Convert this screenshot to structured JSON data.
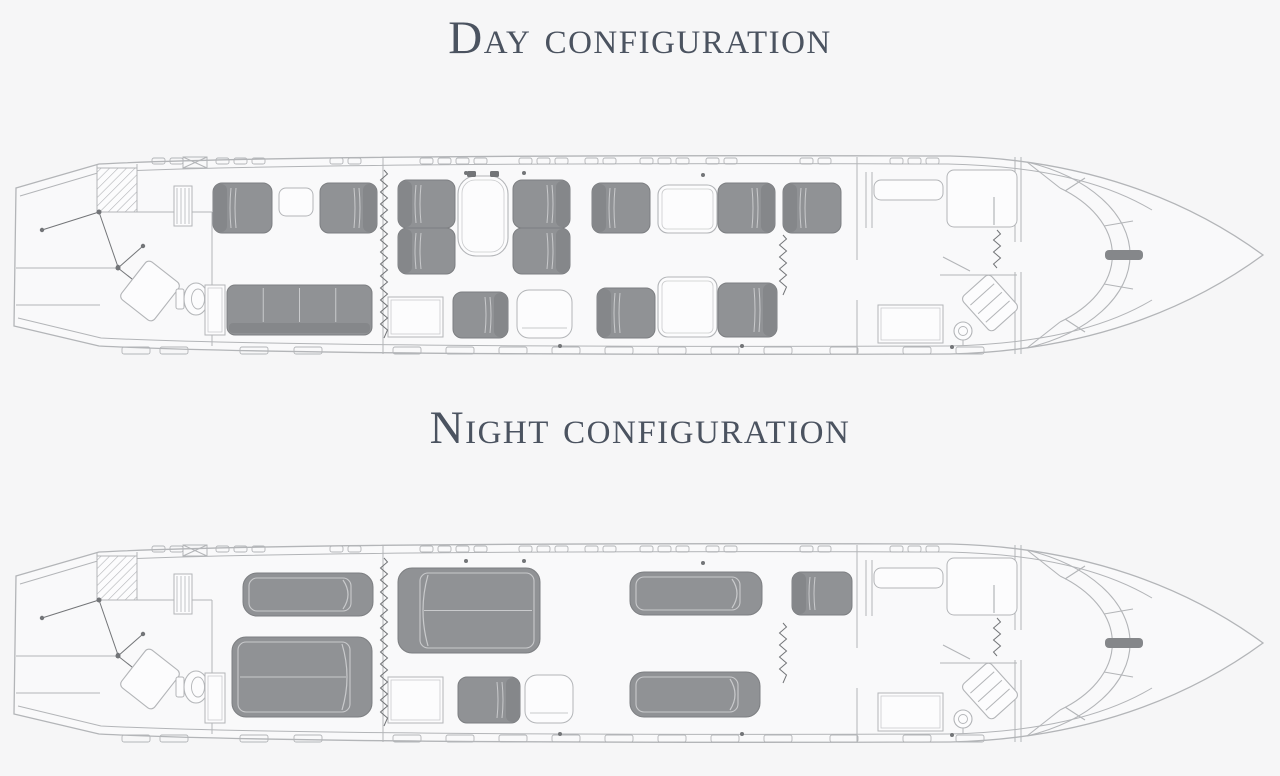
{
  "titles": {
    "day": "Day configuration",
    "night": "Night configuration"
  },
  "colors": {
    "background": "#f6f6f7",
    "cabin_fill": "#f9f9fa",
    "line": "#b3b5b8",
    "seat_fill": "#909295",
    "seat_back": "#85878a",
    "seat_edge": "#7d7f82",
    "seam": "#c9cacc",
    "white_fill": "#fcfcfd",
    "dot": "#737578",
    "title": "#4b5360"
  },
  "fuselage": {
    "hull": "M 16 38 L 99 14 C 260 6 620 5 950 6 C 1085 9 1188 50 1263 105 C 1188 160 1085 201 950 204 C 620 205 260 204 99 196 L 14 176 Z",
    "inner_top": "M 20 46 L 101 22 C 260 14 620 13 948 14 C 1040 16 1105 32 1152 60",
    "inner_bottom": "M 18 168 L 101 188 C 260 196 620 197 948 196 C 1040 194 1105 178 1152 150",
    "windshield": {
      "outer": "M 1027 12 A 163 100 0 0 1 1027 198",
      "inner": "M 1060 38 A 132 84 0 0 1 1060 172",
      "caps": [
        [
          1027,
          12,
          1060,
          38
        ],
        [
          1027,
          198,
          1060,
          172
        ]
      ],
      "dividers": [
        [
          1085,
          28,
          1065,
          41
        ],
        [
          1133,
          71,
          1104,
          76
        ],
        [
          1133,
          139,
          1104,
          134
        ],
        [
          1085,
          182,
          1065,
          169
        ]
      ],
      "apex": [
        1105,
        100,
        38,
        10
      ]
    },
    "exit_box": [
      183,
      7,
      24,
      11
    ],
    "windows_top": [
      152,
      170,
      216,
      234,
      252,
      330,
      348,
      420,
      438,
      456,
      474,
      519,
      537,
      555,
      585,
      603,
      640,
      658,
      676,
      706,
      724,
      800,
      818,
      890,
      908,
      926
    ],
    "windows_bottom": [
      122,
      160,
      240,
      294,
      393,
      446,
      499,
      552,
      605,
      658,
      711,
      764,
      830,
      903,
      956
    ],
    "hull_dots": [
      [
        466,
        23
      ],
      [
        524,
        23
      ],
      [
        703,
        25
      ],
      [
        560,
        196
      ],
      [
        742,
        196
      ],
      [
        952,
        197
      ]
    ],
    "tail_lines": [
      [
        16,
        118,
        120,
        118
      ],
      [
        16,
        155,
        100,
        155
      ],
      [
        97,
        14,
        97,
        62
      ],
      [
        137,
        14,
        137,
        62
      ],
      [
        137,
        62,
        212,
        62
      ],
      [
        212,
        62,
        212,
        196
      ],
      [
        383,
        7,
        383,
        204
      ],
      [
        857,
        7,
        857,
        110
      ],
      [
        857,
        150,
        857,
        204
      ],
      [
        866,
        22,
        866,
        78
      ],
      [
        872,
        22,
        872,
        78
      ],
      [
        940,
        125,
        1017,
        125
      ],
      [
        1015,
        7,
        1015,
        92
      ],
      [
        1015,
        122,
        1015,
        204
      ],
      [
        1021,
        7,
        1021,
        92
      ],
      [
        1021,
        122,
        1021,
        204
      ]
    ]
  },
  "plans": {
    "shared_items": [
      {
        "t": "hatch",
        "x": 97,
        "y": 18,
        "w": 40,
        "h": 44
      },
      {
        "t": "stripecab",
        "x": 174,
        "y": 36,
        "w": 18,
        "h": 40
      },
      {
        "t": "door",
        "hub": [
          99,
          62
        ],
        "tips": [
          [
            42,
            80
          ],
          [
            118,
            117
          ]
        ]
      },
      {
        "t": "door",
        "hub": [
          118,
          118
        ],
        "tips": [
          [
            143,
            96
          ],
          [
            146,
            140
          ]
        ]
      },
      {
        "t": "rotrect",
        "cx": 150,
        "cy": 141,
        "w": 42,
        "h": 48,
        "a": 38,
        "stripes": 0
      },
      {
        "t": "toilet",
        "cx": 196,
        "cy": 149
      },
      {
        "t": "cab_r",
        "x": 874,
        "y": 30,
        "w": 69,
        "h": 20,
        "handle": false
      },
      {
        "t": "cab_r",
        "x": 947,
        "y": 20,
        "w": 70,
        "h": 57,
        "handle": true
      },
      {
        "t": "cab",
        "x": 878,
        "y": 155,
        "w": 65,
        "h": 38
      },
      {
        "t": "diag",
        "x1": 943,
        "y1": 107,
        "x2": 970,
        "y2": 121
      },
      {
        "t": "rotrect",
        "cx": 990,
        "cy": 153,
        "w": 38,
        "h": 46,
        "a": -42,
        "stripes": 3
      },
      {
        "t": "sink",
        "cx": 963,
        "cy": 181
      },
      {
        "t": "curtain",
        "x": 997,
        "y1": 80,
        "y2": 118
      }
    ],
    "day": {
      "items": [
        {
          "t": "cab",
          "x": 205,
          "y": 135,
          "w": 20,
          "h": 50
        },
        {
          "t": "divan",
          "x": 227,
          "y": 135,
          "w": 145,
          "h": 50,
          "cushions": 4
        },
        {
          "t": "seat",
          "x": 213,
          "y": 33,
          "w": 59,
          "h": 50,
          "back": "L"
        },
        {
          "t": "cab_r",
          "x": 279,
          "y": 38,
          "w": 34,
          "h": 28,
          "handle": false
        },
        {
          "t": "seat",
          "x": 320,
          "y": 33,
          "w": 57,
          "h": 50,
          "back": "R"
        },
        {
          "t": "seat",
          "x": 398,
          "y": 30,
          "w": 57,
          "h": 48,
          "back": "L"
        },
        {
          "t": "seat",
          "x": 398,
          "y": 78,
          "w": 57,
          "h": 46,
          "back": "L"
        },
        {
          "t": "table",
          "x": 458,
          "y": 26,
          "w": 50,
          "h": 80,
          "r": 18,
          "knobs": true
        },
        {
          "t": "seat",
          "x": 513,
          "y": 30,
          "w": 57,
          "h": 48,
          "back": "R"
        },
        {
          "t": "seat",
          "x": 513,
          "y": 78,
          "w": 57,
          "h": 46,
          "back": "R"
        },
        {
          "t": "cab",
          "x": 388,
          "y": 147,
          "w": 55,
          "h": 40
        },
        {
          "t": "seat",
          "x": 453,
          "y": 142,
          "w": 55,
          "h": 46,
          "back": "R"
        },
        {
          "t": "ghost",
          "x": 517,
          "y": 140,
          "w": 55,
          "h": 48
        },
        {
          "t": "seat",
          "x": 592,
          "y": 33,
          "w": 58,
          "h": 50,
          "back": "L"
        },
        {
          "t": "table",
          "x": 658,
          "y": 35,
          "w": 59,
          "h": 48,
          "r": 10,
          "knobs": false
        },
        {
          "t": "seat",
          "x": 718,
          "y": 33,
          "w": 57,
          "h": 50,
          "back": "R"
        },
        {
          "t": "seat",
          "x": 783,
          "y": 33,
          "w": 58,
          "h": 50,
          "back": "L"
        },
        {
          "t": "seat",
          "x": 597,
          "y": 138,
          "w": 58,
          "h": 50,
          "back": "L"
        },
        {
          "t": "table",
          "x": 658,
          "y": 127,
          "w": 59,
          "h": 60,
          "r": 10,
          "knobs": false
        },
        {
          "t": "seat",
          "x": 718,
          "y": 133,
          "w": 59,
          "h": 54,
          "back": "R"
        },
        {
          "t": "curtain",
          "x": 384,
          "y1": 20,
          "y2": 188
        },
        {
          "t": "curtain",
          "x": 783,
          "y1": 85,
          "y2": 145
        }
      ]
    },
    "night": {
      "items": [
        {
          "t": "cab",
          "x": 205,
          "y": 135,
          "w": 20,
          "h": 50
        },
        {
          "t": "bed",
          "x": 243,
          "y": 35,
          "w": 130,
          "h": 43,
          "head": "R",
          "seam": false
        },
        {
          "t": "bed",
          "x": 232,
          "y": 99,
          "w": 140,
          "h": 80,
          "head": "R",
          "seam": true
        },
        {
          "t": "bed",
          "x": 398,
          "y": 30,
          "w": 142,
          "h": 85,
          "head": "L",
          "seam": true
        },
        {
          "t": "cab",
          "x": 388,
          "y": 139,
          "w": 55,
          "h": 46
        },
        {
          "t": "seat",
          "x": 458,
          "y": 139,
          "w": 62,
          "h": 46,
          "back": "R"
        },
        {
          "t": "ghost",
          "x": 525,
          "y": 137,
          "w": 48,
          "h": 48
        },
        {
          "t": "bed",
          "x": 630,
          "y": 34,
          "w": 132,
          "h": 43,
          "head": "R",
          "seam": false
        },
        {
          "t": "bed",
          "x": 630,
          "y": 134,
          "w": 130,
          "h": 45,
          "head": "R",
          "seam": false
        },
        {
          "t": "seat",
          "x": 792,
          "y": 34,
          "w": 60,
          "h": 43,
          "back": "L"
        },
        {
          "t": "curtain",
          "x": 384,
          "y1": 20,
          "y2": 188
        },
        {
          "t": "curtain",
          "x": 783,
          "y1": 85,
          "y2": 145
        }
      ]
    }
  }
}
